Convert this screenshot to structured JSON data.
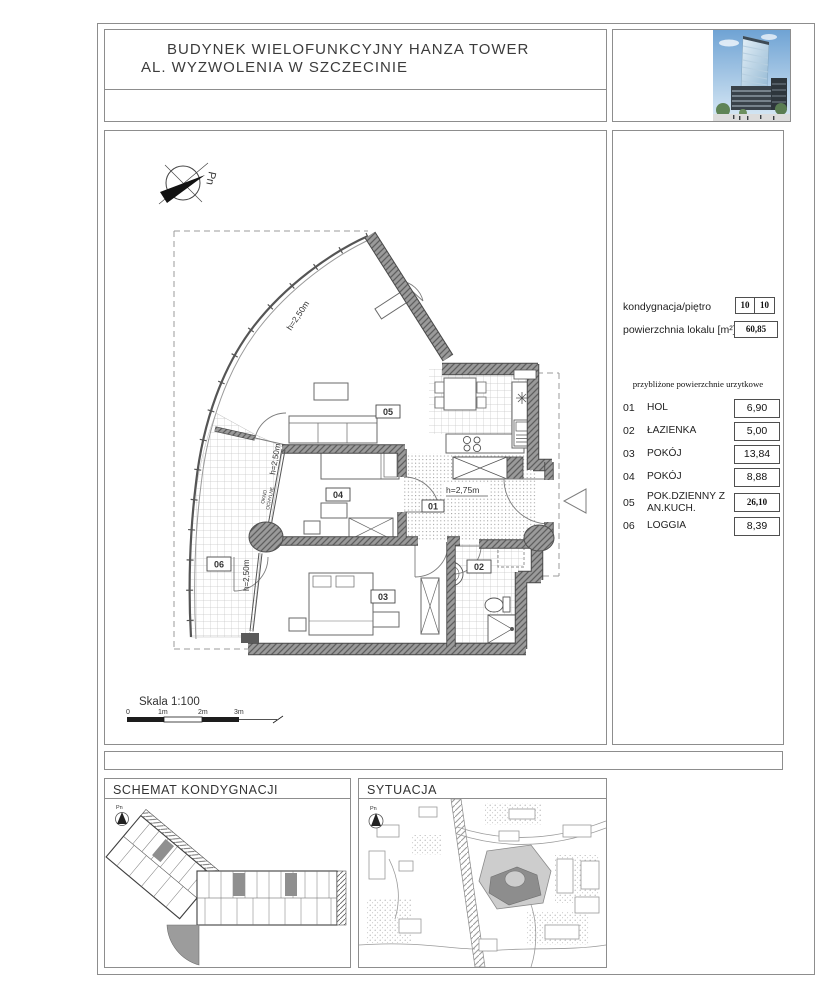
{
  "header": {
    "title_line1": "BUDYNEK WIELOFUNKCYJNY HANZA TOWER",
    "title_line2": "AL. WYZWOLENIA W SZCZECINIE"
  },
  "info": {
    "floor_label": "kondygnacja/piętro",
    "floor_value_1": "10",
    "floor_value_2": "10",
    "area_label": "powierzchnia lokalu [m²]",
    "area_value": "60,85",
    "subheader": "przybliżone powierzchnie urzytkowe",
    "rooms": [
      {
        "no": "01",
        "name": "HOL",
        "area": "6,90"
      },
      {
        "no": "02",
        "name": "ŁAZIENKA",
        "area": "5,00"
      },
      {
        "no": "03",
        "name": "POKÓJ",
        "area": "13,84"
      },
      {
        "no": "04",
        "name": "POKÓJ",
        "area": "8,88"
      },
      {
        "no": "05",
        "name": "POK.DZIENNY Z AN.KUCH.",
        "area": "26,10"
      },
      {
        "no": "06",
        "name": "LOGGIA",
        "area": "8,39"
      }
    ]
  },
  "plan": {
    "north_label": "Pn",
    "room_ids": [
      "01",
      "02",
      "03",
      "04",
      "05",
      "06"
    ],
    "dims": {
      "curve": "h=2,50m",
      "window": "h=2,50m",
      "okno_line1": "OKNO",
      "okno_line2": "OCHYLNE",
      "loggia": "h=2,50m",
      "hall": "h=2,75m"
    },
    "scale": {
      "label": "Skala 1:100",
      "tick0": "0",
      "tick1": "1m",
      "tick2": "2m",
      "tick3": "3m"
    }
  },
  "panels": {
    "schemat": {
      "title": "SCHEMAT KONDYGNACJI",
      "north_label": "Pn"
    },
    "sytuacja": {
      "title": "SYTUACJA",
      "north_label": "Pn"
    }
  },
  "colors": {
    "border": "#8d8d8d",
    "wall": "#7a7a7a",
    "line": "#555555",
    "highlight": "#9c9c9c",
    "sky": "#79aed9"
  }
}
